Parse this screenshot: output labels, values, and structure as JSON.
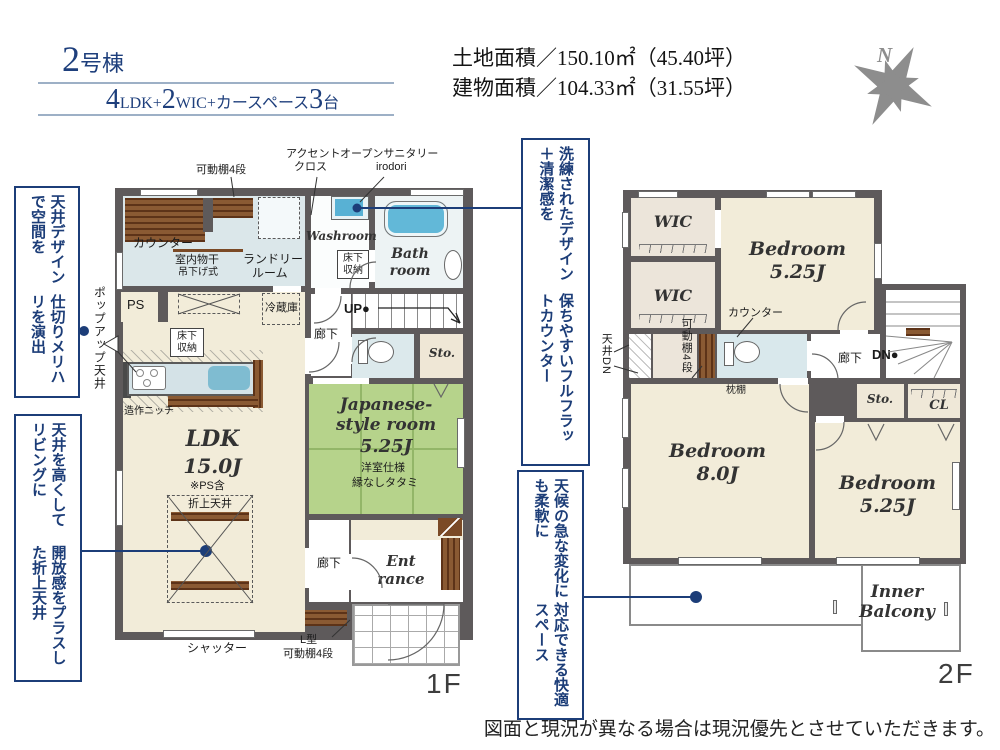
{
  "header": {
    "building": {
      "num": "2",
      "suffix": "号棟"
    },
    "layout": {
      "n1": "4",
      "t1": "LDK+",
      "n2": "2",
      "t2": "WIC+カースペース",
      "n3": "3",
      "t3": "台"
    },
    "land_area": "土地面積／150.10㎡（45.40坪）",
    "building_area": "建物面積／104.33㎡（31.55坪）",
    "compass_n": "N"
  },
  "callouts": {
    "ceiling_design": {
      "l1": "天井デザインで空間を",
      "l2": "仕切りメリハリを演出"
    },
    "oriage": {
      "l1": "天井を高くしてリビングに",
      "l2": "開放感をプラスした折上天井"
    },
    "counter": {
      "l1": "洗練されたデザイン＋清潔感を",
      "l2": "保ちやすいフルフラットカウンター"
    },
    "balcony": {
      "l1": "天候の急な変化にも柔軟に",
      "l2": "対応できる快適スペース"
    }
  },
  "f1": {
    "floor_label": "1F",
    "ldk": {
      "name": "LDK",
      "size": "15.0J",
      "note": "※PS含"
    },
    "tatami": {
      "n1": "Japanese-",
      "n2": "style room",
      "size": "5.25J",
      "s1": "洋室仕様",
      "s2": "縁なしタタミ"
    },
    "washroom": "Washroom",
    "bath": {
      "l1": "Bath",
      "l2": "room"
    },
    "entrance": {
      "l1": "Ent",
      "l2": "rance"
    },
    "sto": "Sto.",
    "hall_up": "廊下",
    "hall_low": "廊下",
    "up": "UP●",
    "ps": "PS",
    "labels": {
      "shelf4": "可動棚4段",
      "accent1": "アクセント",
      "accent2": "クロス",
      "sanitary1": "オープンサニタリー",
      "sanitary2": "irodori",
      "washer": "洗濯機",
      "counter": "カウンター",
      "hoshi1": "室内物干",
      "hoshi2": "吊下げ式",
      "laundry1": "ランドリー",
      "laundry2": "ルーム",
      "floor_storage1": "床下",
      "floor_storage2": "収納",
      "fridge": "冷蔵庫",
      "niche": "造作ニッチ",
      "popup": "ポップアップ天井",
      "oriage": "折上天井",
      "shutter": "シャッター",
      "lshelf1": "L型",
      "lshelf2": "可動棚4段"
    }
  },
  "f2": {
    "floor_label": "2F",
    "wic1": "WIC",
    "wic2": "WIC",
    "bed1": {
      "name": "Bedroom",
      "size": "5.25J"
    },
    "bed2": {
      "name": "Bedroom",
      "size": "8.0J"
    },
    "bed3": {
      "name": "Bedroom",
      "size": "5.25J"
    },
    "balcony": {
      "l1": "Inner",
      "l2": "Balcony"
    },
    "sto": "Sto.",
    "cl": "CL",
    "hall": "廊下",
    "dn": "DN●",
    "labels": {
      "counter": "カウンター",
      "shelf4": "可動棚4段",
      "ceiling_dn": "天井DN",
      "makura": "枕棚"
    }
  },
  "footer": {
    "disclaimer": "図面と現況が異なる場合は現況優先とさせていただきます。"
  },
  "colors": {
    "accent": "#1c3d78",
    "wall": "#5e5a5b",
    "tatami": "#b6d38b",
    "beige": "#f2ecd9",
    "aqua": "#dbe7ea",
    "wood": "#7b4a26",
    "tub": "#62b8d8"
  }
}
